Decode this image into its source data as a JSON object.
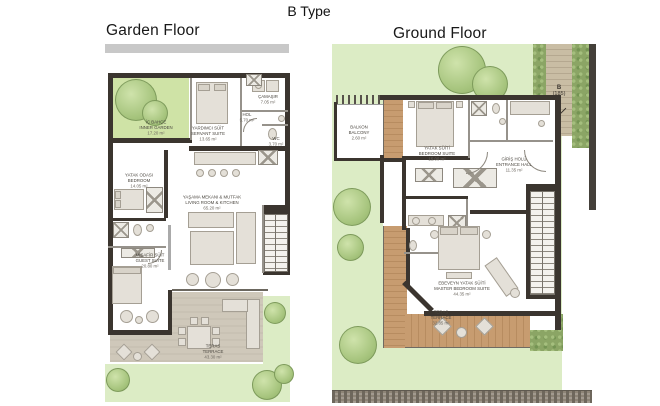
{
  "title": "B Type",
  "plans": {
    "garden": {
      "heading": "Garden Floor",
      "rooms": {
        "inner_garden": {
          "tr": "İÇ BAHÇE",
          "en": "INNER GARDEN",
          "area": "17.20 m²"
        },
        "servant_suite": {
          "tr": "YARDIMCI SÜİT",
          "en": "SERVANT SUITE",
          "area": "13.65 m²"
        },
        "hall": {
          "tr": "HOL",
          "en": "HALL",
          "area": "5.70 m²"
        },
        "laundry": {
          "tr": "ÇAMAŞIR",
          "en": "LAUNDRY",
          "area": "7.05 m²"
        },
        "wc": {
          "tr": "WC",
          "area": "3.70 m²"
        },
        "bedroom": {
          "tr": "YATAK ODASI",
          "en": "BEDROOM",
          "area": "14.05 m²"
        },
        "guest_suite": {
          "tr": "MİSAFİR SÜİT",
          "en": "GUEST SUITE",
          "area": "20.80 m²"
        },
        "living": {
          "tr": "YAŞAMA MEKANI & MUTFAK",
          "en": "LIVING ROOM & KITCHEN",
          "area": "65.20 m²"
        },
        "terrace": {
          "tr": "TERAS",
          "en": "TERRACE",
          "area": "43.30 m²"
        }
      }
    },
    "ground": {
      "heading": "Ground Floor",
      "rooms": {
        "balcony": {
          "tr": "BALKON",
          "en": "BALCONY",
          "area": "2.60 m²"
        },
        "bedroom_suite": {
          "tr": "YATAK SÜİTİ",
          "en": "BEDROOM SUITE",
          "area": "15.00 m²"
        },
        "entrance_hall": {
          "tr": "GİRİŞ HOLÜ",
          "en": "ENTRANCE HALL",
          "area": "11.35 m²"
        },
        "master_suite": {
          "tr": "EBEVEYN YATAK SÜİTİ",
          "en": "MASTER BEDROOM SUITE",
          "area": "44.35 m²"
        },
        "terrace": {
          "tr": "TERAS",
          "en": "TERRACE",
          "area": "32.85 m²"
        }
      },
      "unit_marker": {
        "label": "B",
        "number": "(185)"
      }
    }
  },
  "colors": {
    "wall_dark": "#3b352f",
    "lawn_green": "#dcecc5",
    "inner_garden_green": "#cfe3a6",
    "hedge_green": "#8ba565",
    "terrace_stone": "#cfc8ba",
    "deck_wood": "#c79c70",
    "path_tan": "#c9bda4",
    "stone_wall": "#8d8476"
  }
}
